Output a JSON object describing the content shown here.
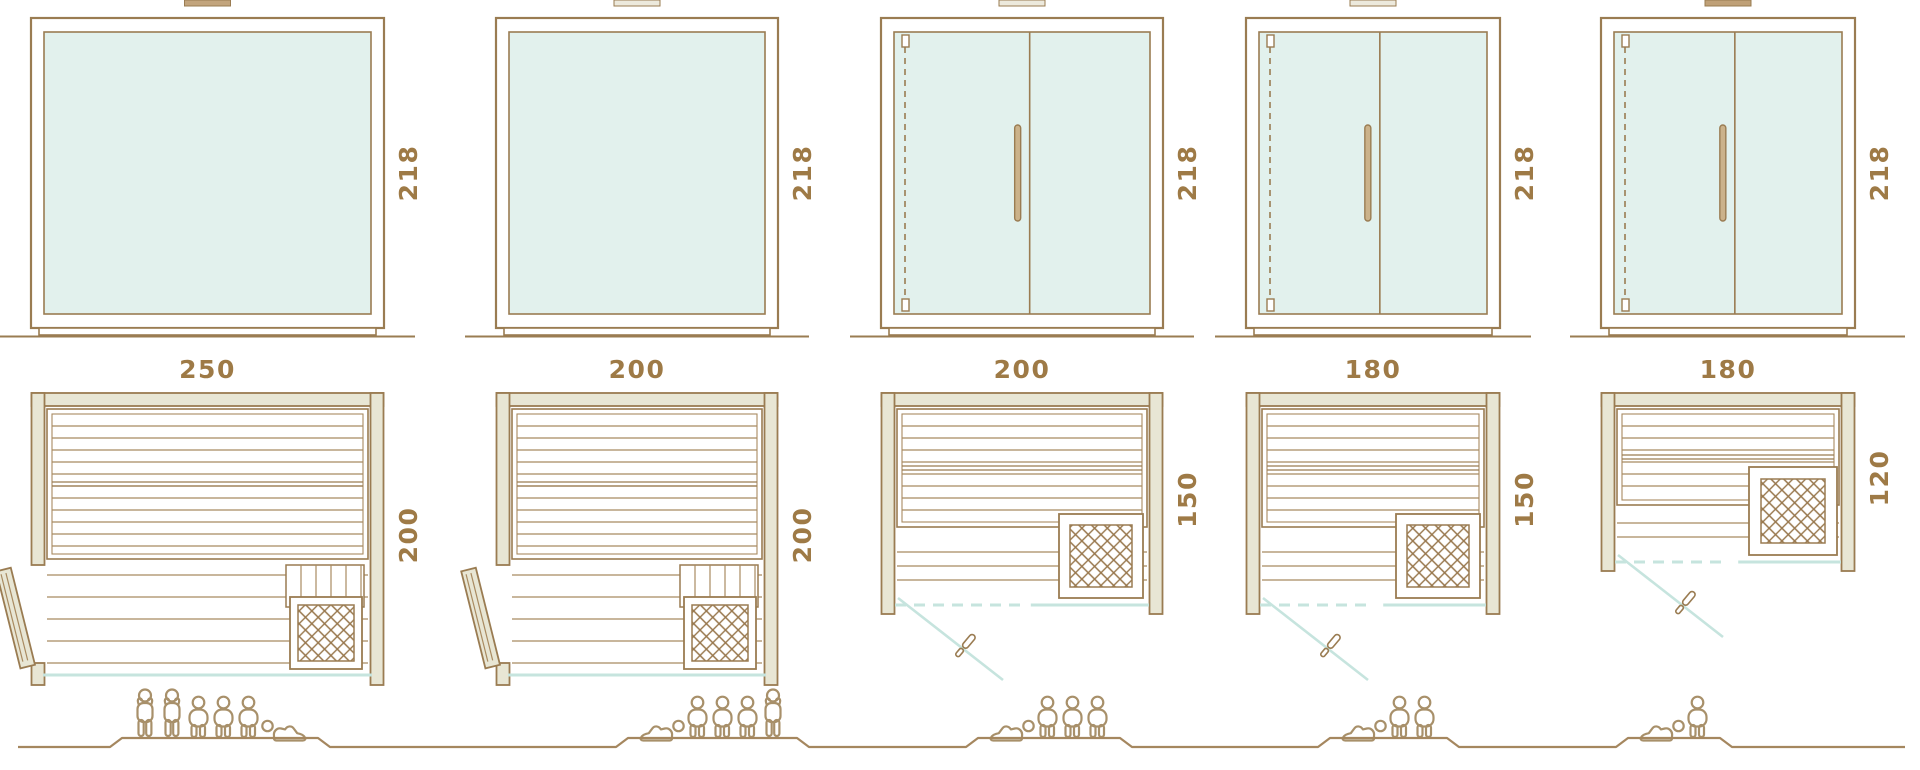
{
  "palette": {
    "outline": "#9a7c52",
    "thin_line": "#a88a60",
    "wall_fill": "#e8e6d4",
    "glass_fill": "#e2f1ed",
    "glass_door_line": "#c6e4de",
    "dimension_text": "#9e7a46",
    "figure_outline": "#a8906a",
    "handle_fill": "#cbb28a"
  },
  "top_tabs": [
    {
      "name": "roof-tab-1",
      "color": "#c2a47c"
    },
    {
      "name": "roof-tab-2",
      "color": "#ece9dc"
    },
    {
      "name": "roof-tab-3",
      "color": "#ece9dc"
    },
    {
      "name": "roof-tab-4",
      "color": "#ece9dc"
    },
    {
      "name": "roof-tab-5",
      "color": "#bfa077"
    }
  ],
  "units": [
    {
      "name": "sauna-250x200",
      "labels": {
        "width": "250",
        "height": "218",
        "depth": "200"
      },
      "elevation": {
        "front": "fixed-glass-panel"
      },
      "plan": {
        "door": "hinged-wood-door-left-wall",
        "heater": "bottom-right"
      },
      "capacity": {
        "count": 6,
        "figures": [
          "standing",
          "standing",
          "sitting",
          "sitting",
          "sitting",
          "lying"
        ]
      }
    },
    {
      "name": "sauna-200x200",
      "labels": {
        "width": "200",
        "height": "218",
        "depth": "200"
      },
      "elevation": {
        "front": "fixed-glass-panel"
      },
      "plan": {
        "door": "hinged-wood-door-left-wall",
        "heater": "bottom-right"
      },
      "capacity": {
        "count": 5,
        "figures": [
          "lying",
          "sitting",
          "sitting",
          "sitting",
          "standing"
        ]
      }
    },
    {
      "name": "sauna-200x150",
      "labels": {
        "width": "200",
        "height": "218",
        "depth": "150"
      },
      "elevation": {
        "front": "glass-door-with-fixed-panel"
      },
      "plan": {
        "door": "glass-front-door-swing-out",
        "heater": "bottom-right"
      },
      "capacity": {
        "count": 4,
        "figures": [
          "lying",
          "sitting",
          "sitting",
          "sitting"
        ]
      }
    },
    {
      "name": "sauna-180x150",
      "labels": {
        "width": "180",
        "height": "218",
        "depth": "150"
      },
      "elevation": {
        "front": "glass-door-with-fixed-panel"
      },
      "plan": {
        "door": "glass-front-door-swing-out",
        "heater": "bottom-right"
      },
      "capacity": {
        "count": 3,
        "figures": [
          "lying",
          "sitting",
          "sitting"
        ]
      }
    },
    {
      "name": "sauna-180x120",
      "labels": {
        "width": "180",
        "height": "218",
        "depth": "120"
      },
      "elevation": {
        "front": "glass-door-with-fixed-panel"
      },
      "plan": {
        "door": "glass-front-door-swing-out",
        "heater": "right"
      },
      "capacity": {
        "count": 2,
        "figures": [
          "lying",
          "sitting"
        ]
      }
    }
  ]
}
